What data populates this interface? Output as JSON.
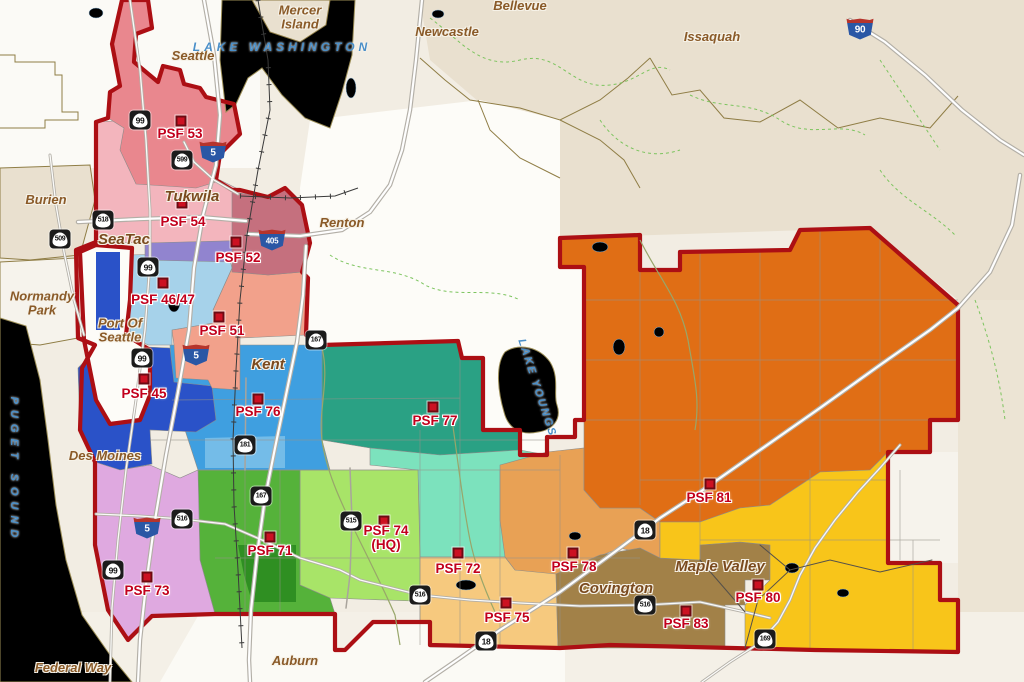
{
  "map": {
    "district_colors": {
      "psf53": "#e9878e",
      "psf54": "#f3b5bd",
      "psf52": "#c5707e",
      "psf4647": "#a6d2ea",
      "psf4647_purple": "#9184cf",
      "psf51": "#f2a18b",
      "psf45": "#2a52c8",
      "psf76": "#3f9fe0",
      "psf76_light": "#74bce8",
      "psf77": "#2aa184",
      "psf72": "#7ce2bd",
      "psf71": "#55b23a",
      "psf71_dark": "#2f8f22",
      "psf74": "#a8e468",
      "psf75": "#f6c97e",
      "psf78": "#e8a155",
      "psf81": "#e06e15",
      "psf80": "#f8c51a",
      "psf83": "#a28148",
      "psf73": "#dfa9e0",
      "water": "#b8d7eb",
      "district_border": "#ac0f14",
      "marker": "#cc1122"
    },
    "label_colors": {
      "station": "#c2001c",
      "city_small": "#8a5a28",
      "city_large": "#7a4a1e",
      "water": "#4a8fc8"
    },
    "psf_stations": [
      {
        "label": "PSF 53",
        "marker": {
          "x": 181,
          "y": 121
        },
        "label_pos": {
          "x": 180,
          "y": 134
        }
      },
      {
        "label": "PSF 54",
        "marker": {
          "x": 182,
          "y": 203
        },
        "label_pos": {
          "x": 183,
          "y": 222
        }
      },
      {
        "label": "PSF 52",
        "marker": {
          "x": 236,
          "y": 242
        },
        "label_pos": {
          "x": 238,
          "y": 258
        }
      },
      {
        "label": "PSF 46/47",
        "marker": {
          "x": 163,
          "y": 283
        },
        "label_pos": {
          "x": 163,
          "y": 300
        }
      },
      {
        "label": "PSF 51",
        "marker": {
          "x": 219,
          "y": 317
        },
        "label_pos": {
          "x": 222,
          "y": 331
        }
      },
      {
        "label": "PSF 45",
        "marker": {
          "x": 144,
          "y": 379
        },
        "label_pos": {
          "x": 144,
          "y": 394
        }
      },
      {
        "label": "PSF 76",
        "marker": {
          "x": 258,
          "y": 399
        },
        "label_pos": {
          "x": 258,
          "y": 412
        }
      },
      {
        "label": "PSF 77",
        "marker": {
          "x": 433,
          "y": 407
        },
        "label_pos": {
          "x": 435,
          "y": 421
        }
      },
      {
        "label": "PSF 81",
        "marker": {
          "x": 710,
          "y": 484
        },
        "label_pos": {
          "x": 709,
          "y": 498
        }
      },
      {
        "label": "PSF 71",
        "marker": {
          "x": 270,
          "y": 537
        },
        "label_pos": {
          "x": 270,
          "y": 551
        }
      },
      {
        "lines": [
          "PSF 74",
          "(HQ)"
        ],
        "marker": {
          "x": 384,
          "y": 521
        },
        "label_pos": {
          "x": 386,
          "y": 538
        }
      },
      {
        "label": "PSF 72",
        "marker": {
          "x": 458,
          "y": 553
        },
        "label_pos": {
          "x": 458,
          "y": 569
        }
      },
      {
        "label": "PSF 78",
        "marker": {
          "x": 573,
          "y": 553
        },
        "label_pos": {
          "x": 574,
          "y": 567
        }
      },
      {
        "label": "PSF 75",
        "marker": {
          "x": 506,
          "y": 603
        },
        "label_pos": {
          "x": 507,
          "y": 618
        }
      },
      {
        "label": "PSF 83",
        "marker": {
          "x": 686,
          "y": 611
        },
        "label_pos": {
          "x": 686,
          "y": 624
        }
      },
      {
        "label": "PSF 80",
        "marker": {
          "x": 758,
          "y": 585
        },
        "label_pos": {
          "x": 758,
          "y": 598
        }
      },
      {
        "label": "PSF 73",
        "marker": {
          "x": 147,
          "y": 577
        },
        "label_pos": {
          "x": 147,
          "y": 591
        }
      }
    ],
    "cities": [
      {
        "name": "Seattle",
        "x": 193,
        "y": 56,
        "style": "small"
      },
      {
        "name": "Bellevue",
        "x": 520,
        "y": 6,
        "style": "small"
      },
      {
        "name": "Newcastle",
        "x": 447,
        "y": 32,
        "style": "small"
      },
      {
        "name": "Issaquah",
        "x": 712,
        "y": 37,
        "style": "small"
      },
      {
        "lines": [
          "Mercer",
          "Island"
        ],
        "x": 300,
        "y": 18,
        "style": "small"
      },
      {
        "name": "Burien",
        "x": 46,
        "y": 200,
        "style": "small"
      },
      {
        "lines": [
          "Normandy",
          "Park"
        ],
        "x": 42,
        "y": 304,
        "style": "small"
      },
      {
        "lines": [
          "Port Of",
          "Seattle"
        ],
        "x": 120,
        "y": 331,
        "style": "small"
      },
      {
        "name": "Tukwila",
        "x": 192,
        "y": 197,
        "style": "large"
      },
      {
        "name": "SeaTac",
        "x": 124,
        "y": 240,
        "style": "large"
      },
      {
        "name": "Renton",
        "x": 342,
        "y": 223,
        "style": "small"
      },
      {
        "name": "Kent",
        "x": 268,
        "y": 365,
        "style": "large"
      },
      {
        "name": "Des Moines",
        "x": 105,
        "y": 456,
        "style": "small"
      },
      {
        "name": "Covington",
        "x": 616,
        "y": 589,
        "style": "large"
      },
      {
        "name": "Maple Valley",
        "x": 720,
        "y": 567,
        "style": "large"
      },
      {
        "name": "Auburn",
        "x": 295,
        "y": 661,
        "style": "small"
      },
      {
        "name": "Federal Way",
        "x": 73,
        "y": 668,
        "style": "small"
      }
    ],
    "water_labels": [
      {
        "name": "LAKE WASHINGTON",
        "x": 282,
        "y": 47,
        "rotate": 0,
        "spacing": 4,
        "size": 12
      },
      {
        "name": "PUGET SOUND",
        "x": 14,
        "y": 470,
        "rotate": 90,
        "spacing": 6,
        "size": 11
      },
      {
        "name": "LAKE YOUNGS",
        "x": 537,
        "y": 388,
        "rotate": 72,
        "spacing": 2,
        "size": 11
      }
    ],
    "route_shields": [
      {
        "type": "interstate",
        "number": "5",
        "x": 213,
        "y": 151
      },
      {
        "type": "interstate",
        "number": "5",
        "x": 196,
        "y": 354
      },
      {
        "type": "interstate",
        "number": "5",
        "x": 147,
        "y": 527
      },
      {
        "type": "interstate",
        "number": "405",
        "x": 272,
        "y": 239
      },
      {
        "type": "interstate",
        "number": "90",
        "x": 860,
        "y": 28
      },
      {
        "type": "state",
        "number": "99",
        "x": 140,
        "y": 120
      },
      {
        "type": "state",
        "number": "599",
        "x": 182,
        "y": 160
      },
      {
        "type": "state",
        "number": "518",
        "x": 103,
        "y": 220
      },
      {
        "type": "state",
        "number": "509",
        "x": 60,
        "y": 239
      },
      {
        "type": "state",
        "number": "99",
        "x": 148,
        "y": 267
      },
      {
        "type": "state",
        "number": "167",
        "x": 316,
        "y": 340
      },
      {
        "type": "state",
        "number": "99",
        "x": 142,
        "y": 358
      },
      {
        "type": "state",
        "number": "181",
        "x": 245,
        "y": 445
      },
      {
        "type": "state",
        "number": "167",
        "x": 261,
        "y": 496
      },
      {
        "type": "state",
        "number": "515",
        "x": 351,
        "y": 521
      },
      {
        "type": "state",
        "number": "516",
        "x": 182,
        "y": 519
      },
      {
        "type": "state",
        "number": "99",
        "x": 113,
        "y": 570
      },
      {
        "type": "state",
        "number": "516",
        "x": 420,
        "y": 595
      },
      {
        "type": "state",
        "number": "18",
        "x": 645,
        "y": 530
      },
      {
        "type": "state",
        "number": "516",
        "x": 645,
        "y": 605
      },
      {
        "type": "state",
        "number": "18",
        "x": 486,
        "y": 641
      },
      {
        "type": "state",
        "number": "169",
        "x": 765,
        "y": 639
      }
    ]
  }
}
